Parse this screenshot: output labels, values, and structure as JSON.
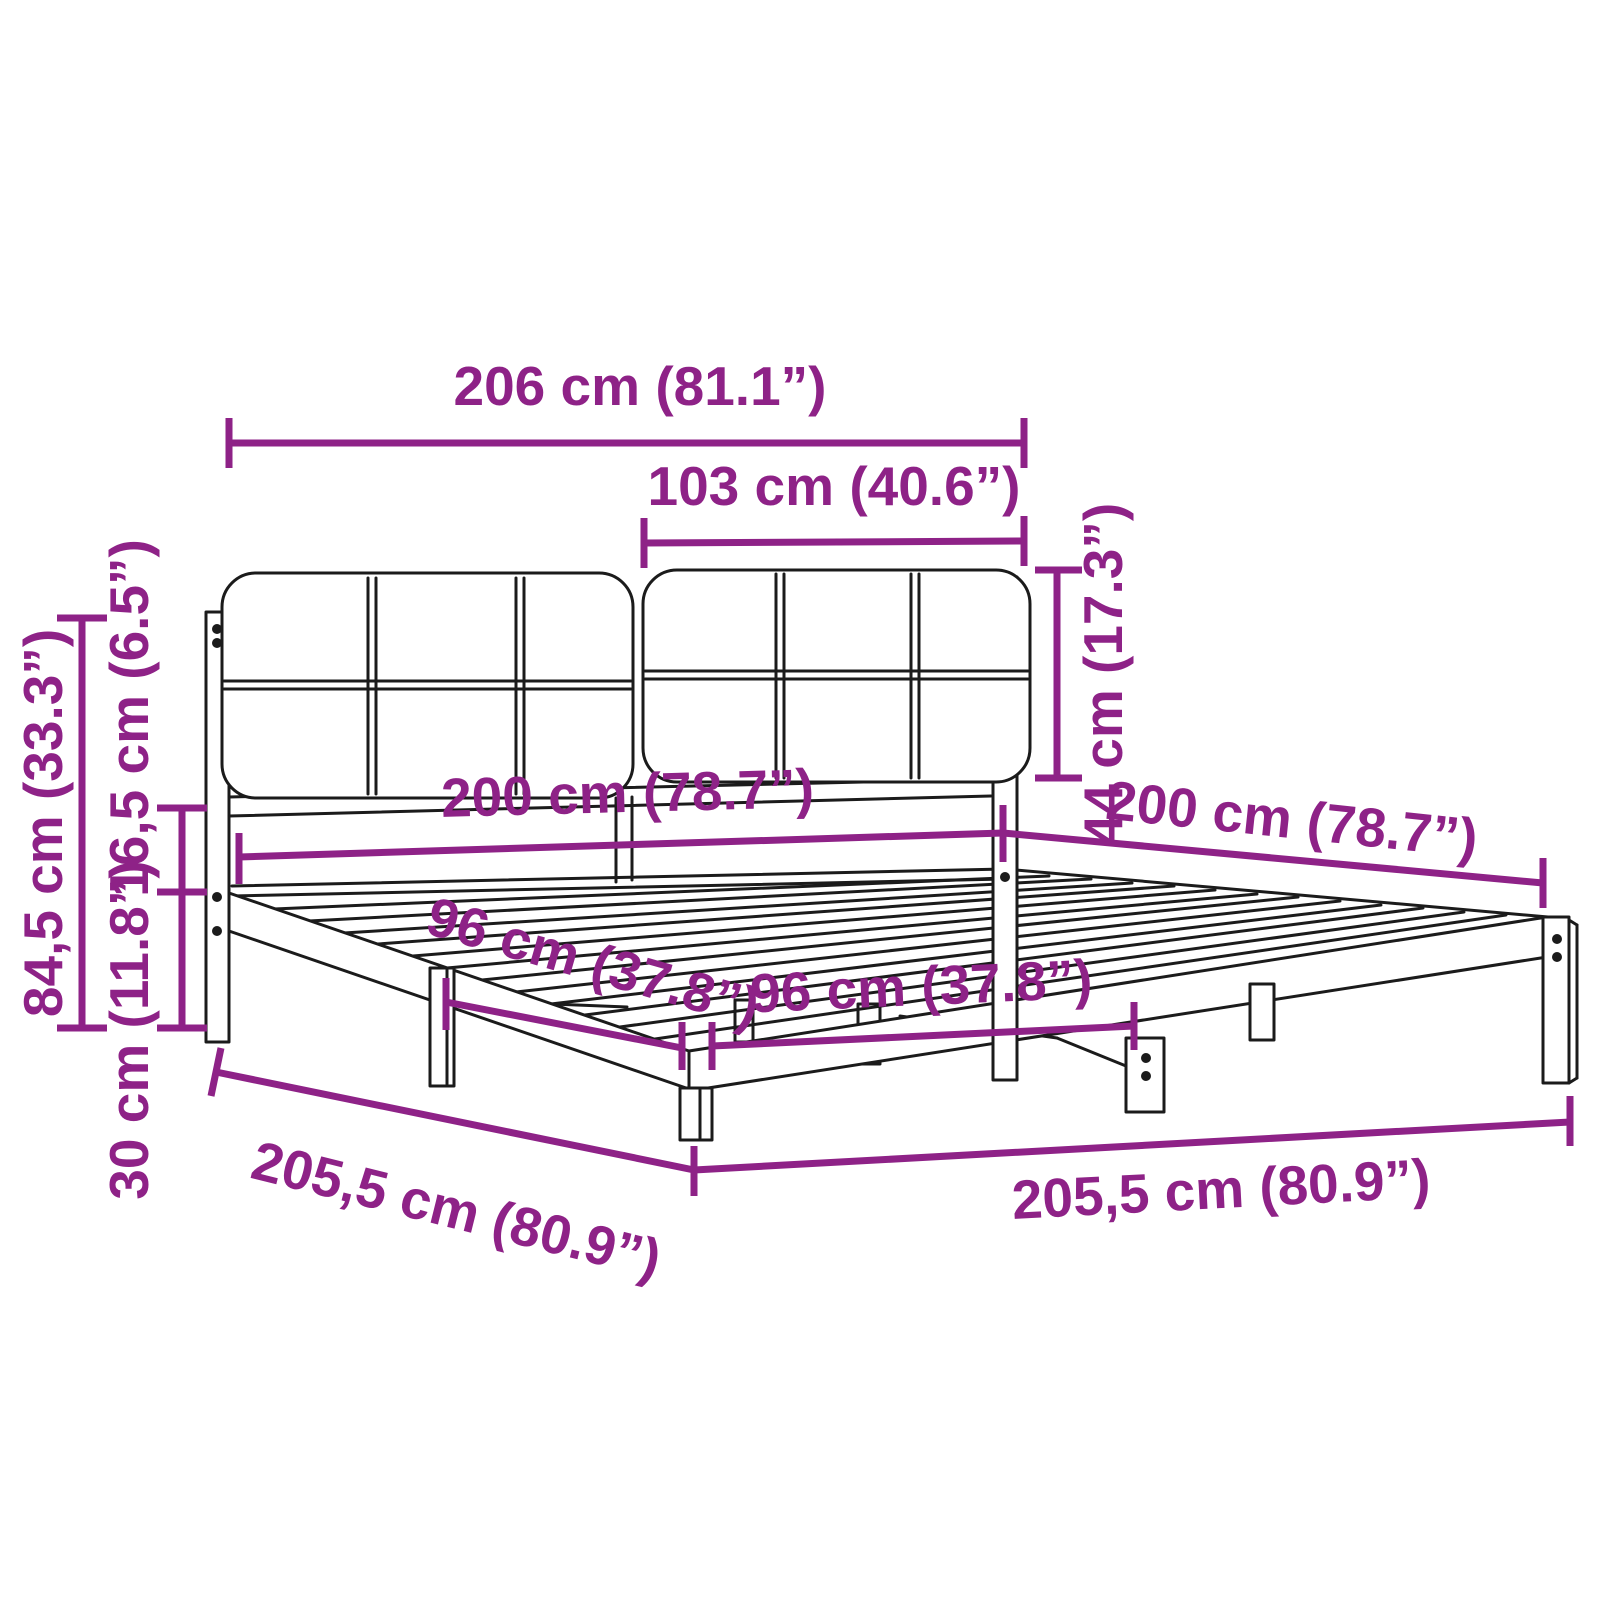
{
  "title": "Bed frame with upholstered headboard — dimension diagram",
  "colors": {
    "dimension": "#8E2287",
    "line_art": "#1b1b1b",
    "background": "#ffffff"
  },
  "diagram": {
    "product": "bed-frame-with-headboard",
    "labels": {
      "total_width": "206 cm (81.1”)",
      "headboard_half_width": "103 cm (40.6”)",
      "headboard_height": "44 cm (17.3”)",
      "bed_width": "200 cm (78.7”)",
      "bed_length": "200 cm (78.7”)",
      "side_leg_spacing": "96 cm (37.8”)",
      "front_leg_spacing": "96 cm (37.8”)",
      "frame_length": "205,5 cm (80.9”)",
      "frame_width": "205,5 cm (80.9”)",
      "total_height": "84,5 cm (33.3”)",
      "rail_height": "16,5 cm (6.5”)",
      "base_height": "30 cm (11.8”)"
    }
  }
}
